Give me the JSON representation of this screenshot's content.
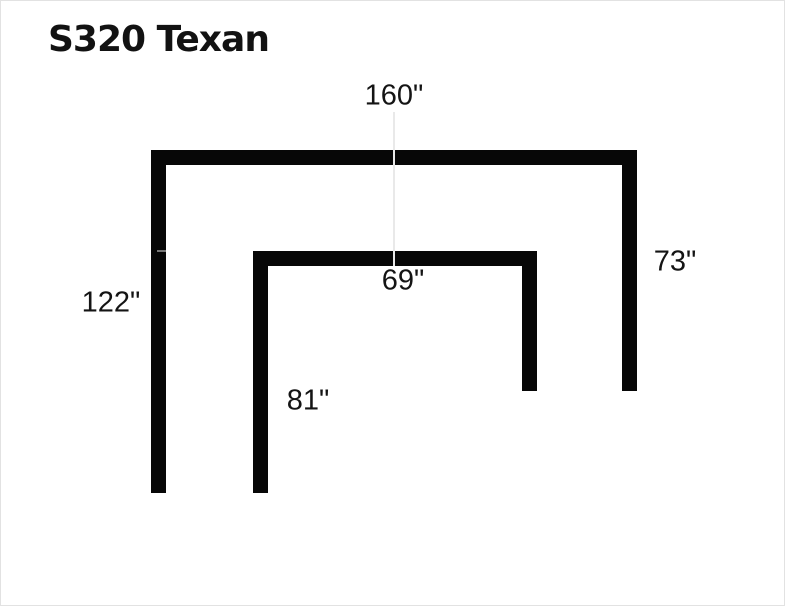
{
  "page": {
    "background_color": "#ffffff",
    "bar_color": "#070707",
    "guide_line_color": "#e9e9e9",
    "text_color": "#141414"
  },
  "title": {
    "text": "S320 Texan"
  },
  "diagram": {
    "type": "sectional-sofa-dimension-diagram",
    "unit": "inches",
    "sections": {
      "outer": {
        "top_width_in": 160,
        "left_depth_in": 122,
        "right_depth_in": 73
      },
      "inner": {
        "top_width_in": 69,
        "left_depth_in": 81
      }
    },
    "labels": {
      "outer_width": {
        "text": "160\""
      },
      "inner_width": {
        "text": "69\""
      },
      "outer_left_height": {
        "text": "122\""
      },
      "outer_right_height": {
        "text": "73\""
      },
      "inner_left_height": {
        "text": "81\""
      }
    }
  }
}
